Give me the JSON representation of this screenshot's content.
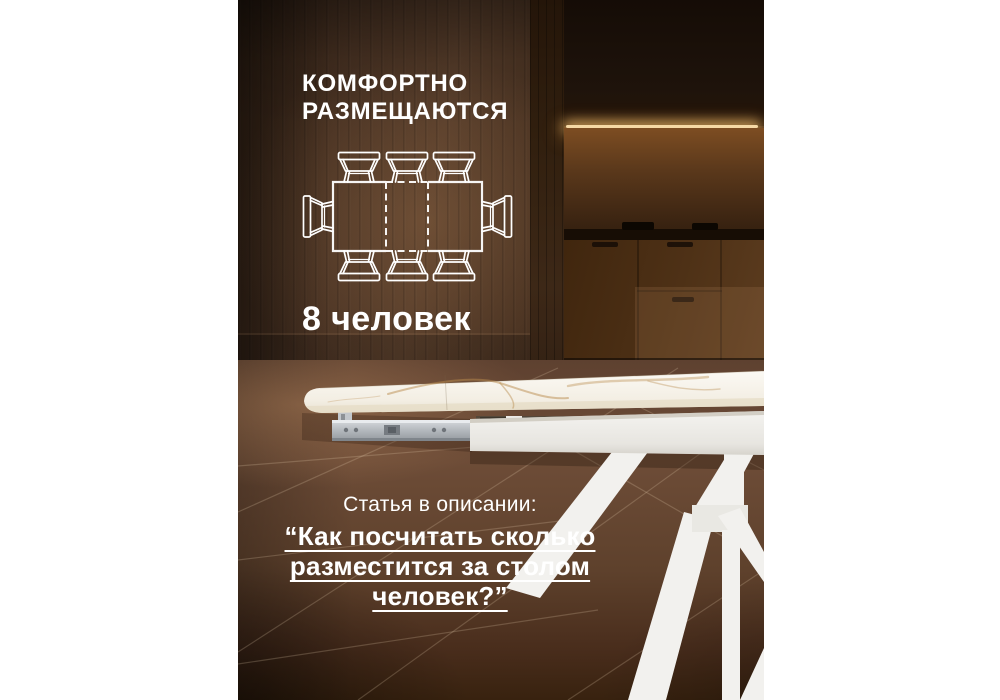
{
  "headline": {
    "line1": "КОМФОРТНО",
    "line2": "РАЗМЕЩАЮТСЯ"
  },
  "capacity": {
    "label": "8 человек"
  },
  "article": {
    "intro": "Статья в описании:",
    "quote_lines": [
      "“Как посчитать сколько",
      "разместится за столом",
      "человек?”"
    ]
  },
  "diagram": {
    "icon": "table-seating-top-view-icon",
    "total_seats": 8,
    "seats_top": 3,
    "seats_bottom": 3,
    "seats_left": 1,
    "seats_right": 1
  },
  "colors": {
    "text": "#ffffff",
    "wall_wood": "#543b29",
    "kitchen_dark": "#1e130b",
    "led_glow": "#f6d9a6",
    "floor": "#6d4c37",
    "table_white": "#f4f2ed",
    "marble_vein": "#b98c4e"
  }
}
